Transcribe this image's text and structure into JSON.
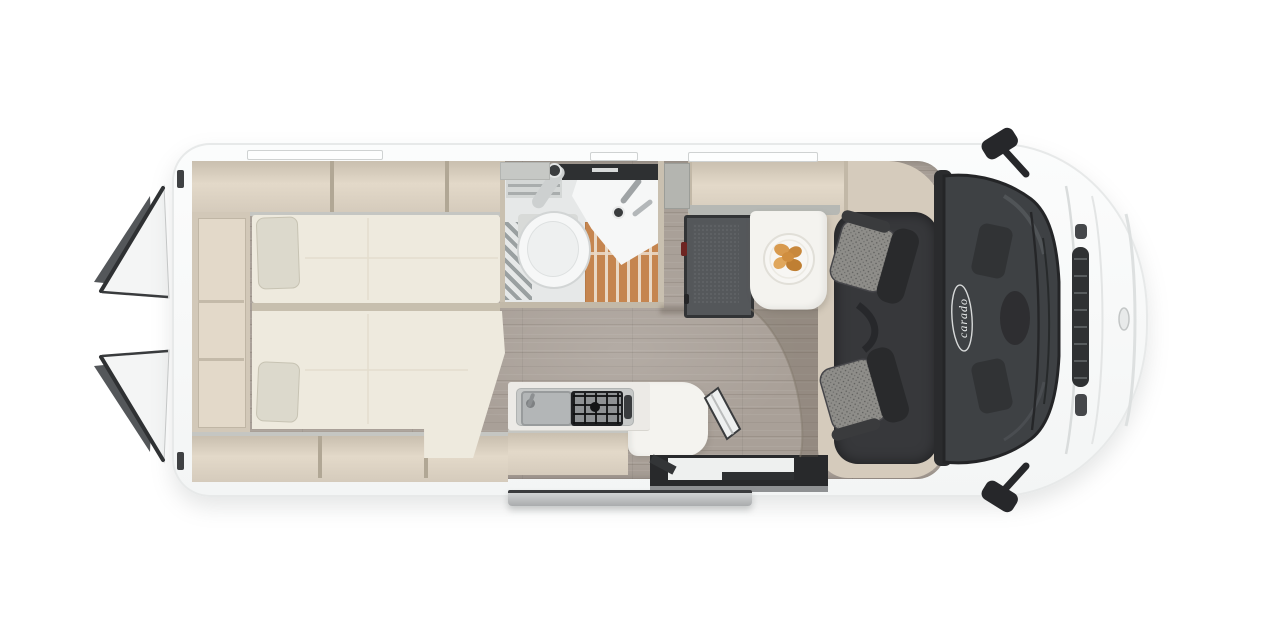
{
  "scene": {
    "description": "top view floor plan render of a camper van with rear doors open",
    "background": "#ffffff"
  },
  "logo": {
    "text": "carado"
  },
  "colors": {
    "body": "#f9fafa",
    "body_edge": "#e7e9e9",
    "beige": "#d5cbbc",
    "beige_light": "#e3d9c9",
    "beige_dark": "#c9bfaf",
    "lip_gray": "#c5c6c2",
    "divider": "#b1a795",
    "bed_cream": "#eeeade",
    "bed_gap": "#c7bfae",
    "cushion": "#dcd9cc",
    "wood": "#a9a098",
    "wood_line": "#8f877e",
    "wood_dark": "#9a8d80",
    "bath_floor": "#e6e8e8",
    "fixture": "#f6f7f7",
    "fixture_shade": "#d2d5d5",
    "dark_strip": "#2e3032",
    "slat": "#c5854f",
    "slat_gap": "#e9d8c5",
    "mat_stripe": "#9aa0a1",
    "fridge": "#54575a",
    "fridge_frame": "#323436",
    "latch": "#6e2522",
    "gray_cab": "#b4b5b0",
    "shelf_lip": "#b6b8b4",
    "table": "#f4f3ef",
    "counter": "#eceae6",
    "hob_frame": "#1f2022",
    "seat_dark": "#292a2c",
    "seat_fabric": "#8e8d89",
    "seat_mat": "#37383b",
    "glass": "#3e4144",
    "glass_edge": "#242527",
    "hood_line": "#d9dcdc",
    "grille": "#2f3133",
    "grille_rib": "#585c5e",
    "mirror": "#26272a",
    "step": "#b8babb",
    "step_edge": "#3a3b3d",
    "door_white": "#f4f5f5",
    "door_dark": "#2f3133",
    "door_gray": "#54575a",
    "logo": "#eef0f0",
    "well_white": "#eef0ef",
    "croissant": "#d89a4e",
    "croissant_dark": "#bf7f33",
    "plate_ring": "#e1dfd8"
  },
  "items": {
    "rear_doors": "open rear barn doors",
    "wardrobe": "rear wardrobe column",
    "overhead_lockers": "beige overhead storage lockers",
    "beds": "two longitudinal single beds with headrest cushions",
    "bathroom": "wet room with toilet, corner washbasin, teak shower grate and mat",
    "kitchen": "kitchen block with sink, two burner gas hob and white worktop extension",
    "fridge": "dark compressor fridge tower",
    "dinette": "white pedestal table with breakfast plate",
    "seats": "two swivelled cab captain seats with grey upholstery",
    "cab": "driver cab with windshield, wipers, mirrors and hood",
    "entry": "open sliding door with electric entry step",
    "brand": "carado"
  }
}
